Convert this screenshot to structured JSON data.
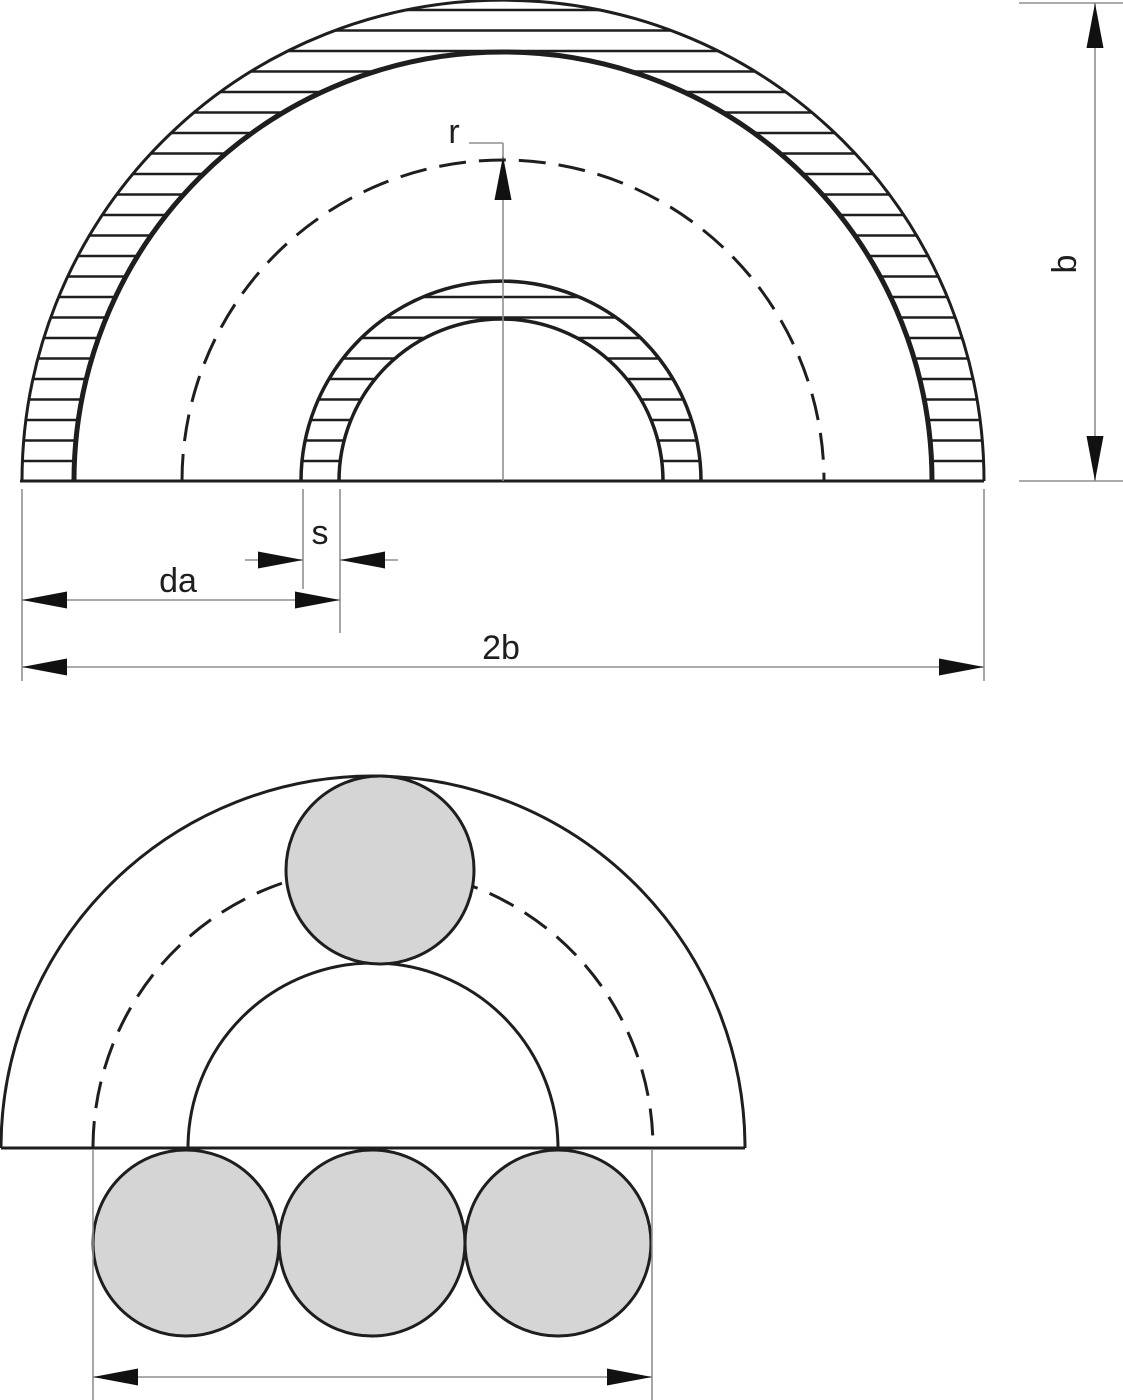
{
  "drawing": {
    "labels": {
      "centerline_radius": "r",
      "wall_thickness": "s",
      "pipe_outer_diameter": "da",
      "overall_width": "2b",
      "overall_height": "b"
    },
    "colors": {
      "line": "#1e1e1e",
      "dimension_line": "#8f8f8f",
      "arrow_fill": "#111111",
      "circle_fill": "#d5d5d5",
      "background": "#ffffff"
    }
  }
}
